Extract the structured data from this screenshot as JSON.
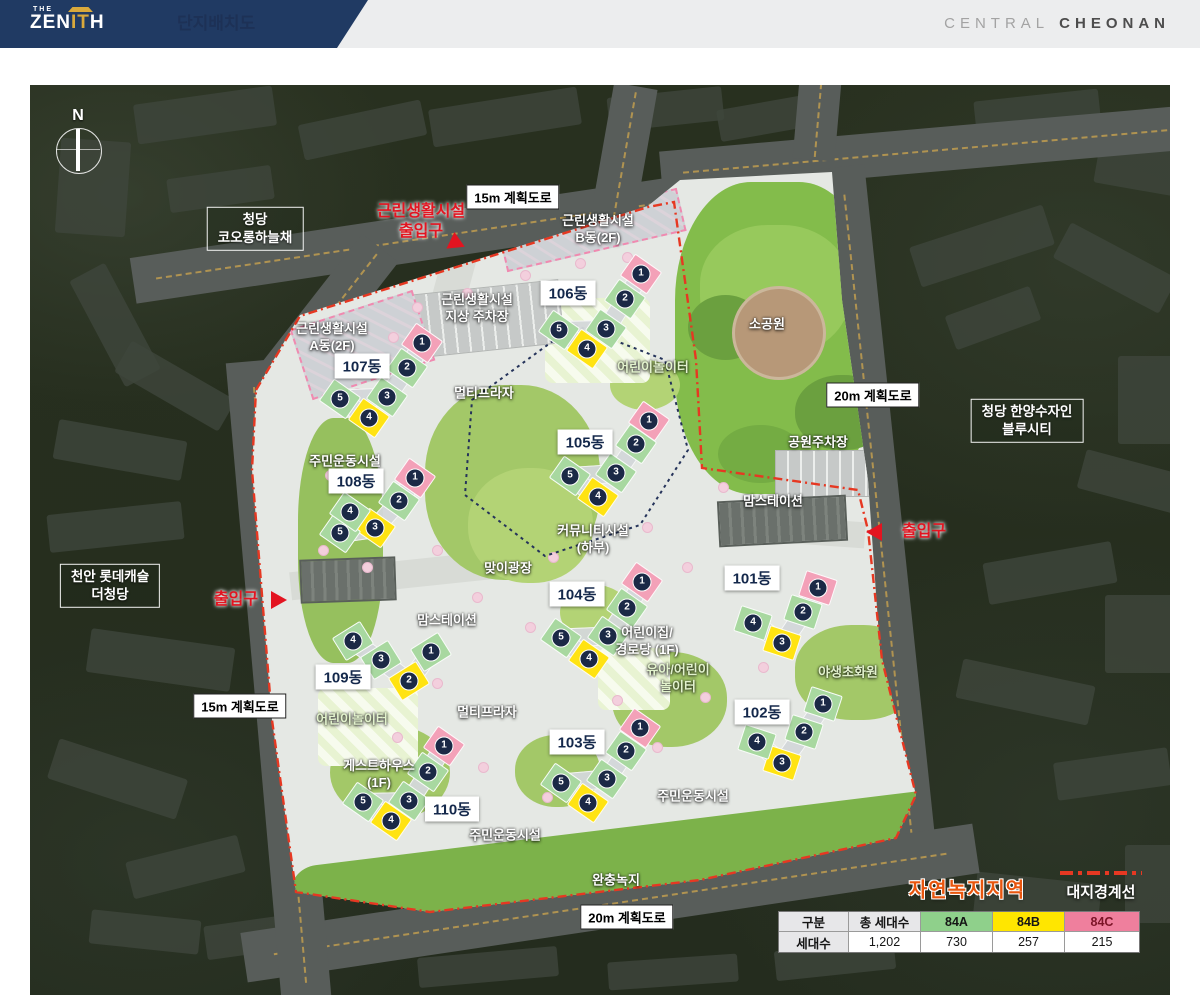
{
  "header": {
    "logo": {
      "the": "THE",
      "zen": "ZEN",
      "pillars": "IT",
      "th": "H"
    },
    "title": "단지배치도",
    "brand": {
      "light": "CENTRAL",
      "bold": "CHEONAN"
    }
  },
  "map": {
    "compass": "N",
    "road_labels": [
      {
        "text": "15m 계획도로",
        "x": 513,
        "y": 197
      },
      {
        "text": "15m 계획도로",
        "x": 240,
        "y": 706
      },
      {
        "text": "20m 계획도로",
        "x": 873,
        "y": 395
      },
      {
        "text": "20m 계획도로",
        "x": 627,
        "y": 917
      }
    ],
    "neighbors": [
      {
        "lines": [
          "청당",
          "코오롱하늘채"
        ],
        "x": 255,
        "y": 229
      },
      {
        "lines": [
          "청당 한양수자인",
          "블루시티"
        ],
        "x": 1027,
        "y": 421
      },
      {
        "lines": [
          "천안 롯데캐슬",
          "더청당"
        ],
        "x": 110,
        "y": 586
      }
    ],
    "entrances": [
      {
        "lines": [
          "근린생활시설",
          "출입구"
        ],
        "x": 421,
        "y": 222,
        "tri": {
          "x": 453,
          "y": 244,
          "dir": "left",
          "rot": -35
        }
      },
      {
        "lines": [
          "출입구"
        ],
        "x": 236,
        "y": 600,
        "tri": {
          "x": 279,
          "y": 600,
          "dir": "right",
          "rot": 0
        }
      },
      {
        "lines": [
          "출입구"
        ],
        "x": 924,
        "y": 532,
        "tri": {
          "x": 874,
          "y": 532,
          "dir": "left",
          "rot": 0
        }
      }
    ],
    "facilities": [
      {
        "lines": [
          "근린생활시설",
          "지상 주차장"
        ],
        "x": 477,
        "y": 309,
        "tone": "w"
      },
      {
        "lines": [
          "근린생활시설",
          "B동(2F)"
        ],
        "x": 598,
        "y": 230,
        "tone": "w"
      },
      {
        "lines": [
          "근린생활시설",
          "A동(2F)"
        ],
        "x": 332,
        "y": 338,
        "tone": "w"
      },
      {
        "lines": [
          "멀티프라자"
        ],
        "x": 484,
        "y": 394,
        "tone": "w"
      },
      {
        "lines": [
          "멀티프라자"
        ],
        "x": 487,
        "y": 713,
        "tone": "w"
      },
      {
        "lines": [
          "주민운동시설"
        ],
        "x": 345,
        "y": 462,
        "tone": "w"
      },
      {
        "lines": [
          "주민운동시설"
        ],
        "x": 505,
        "y": 836,
        "tone": "w"
      },
      {
        "lines": [
          "주민운동시설"
        ],
        "x": 693,
        "y": 797,
        "tone": "w"
      },
      {
        "lines": [
          "어린이놀이터"
        ],
        "x": 653,
        "y": 368,
        "tone": "g"
      },
      {
        "lines": [
          "어린이놀이터"
        ],
        "x": 352,
        "y": 720,
        "tone": "g"
      },
      {
        "lines": [
          "유아/어린이",
          "놀이터"
        ],
        "x": 678,
        "y": 679,
        "tone": "g"
      },
      {
        "lines": [
          "야생초화원"
        ],
        "x": 848,
        "y": 673,
        "tone": "g"
      },
      {
        "lines": [
          "커뮤니티시설",
          "(하부)"
        ],
        "x": 593,
        "y": 540,
        "tone": "w"
      },
      {
        "lines": [
          "맞이광장"
        ],
        "x": 508,
        "y": 569,
        "tone": "w"
      },
      {
        "lines": [
          "맘스테이션"
        ],
        "x": 773,
        "y": 502,
        "tone": "w"
      },
      {
        "lines": [
          "맘스테이션"
        ],
        "x": 447,
        "y": 621,
        "tone": "w"
      },
      {
        "lines": [
          "어린이집/",
          "경로당 (1F)"
        ],
        "x": 647,
        "y": 642,
        "tone": "w"
      },
      {
        "lines": [
          "게스트하우스",
          "(1F)"
        ],
        "x": 379,
        "y": 775,
        "tone": "w"
      },
      {
        "lines": [
          "소공원"
        ],
        "x": 767,
        "y": 325,
        "tone": "w"
      },
      {
        "lines": [
          "공원주차장"
        ],
        "x": 818,
        "y": 443,
        "tone": "w"
      },
      {
        "lines": [
          "완충녹지"
        ],
        "x": 616,
        "y": 881,
        "tone": "w"
      }
    ],
    "dong_labels": [
      {
        "text": "101동",
        "x": 752,
        "y": 578
      },
      {
        "text": "102동",
        "x": 762,
        "y": 712
      },
      {
        "text": "103동",
        "x": 577,
        "y": 742
      },
      {
        "text": "104동",
        "x": 577,
        "y": 594
      },
      {
        "text": "105동",
        "x": 585,
        "y": 442
      },
      {
        "text": "106동",
        "x": 568,
        "y": 293
      },
      {
        "text": "107동",
        "x": 362,
        "y": 366
      },
      {
        "text": "108동",
        "x": 356,
        "y": 481
      },
      {
        "text": "109동",
        "x": 343,
        "y": 677
      },
      {
        "text": "110동",
        "x": 452,
        "y": 809
      }
    ],
    "buildings": [
      {
        "name": "101동",
        "angle": 18,
        "units": [
          {
            "n": "1",
            "x": 818,
            "y": 588,
            "c": "pink"
          },
          {
            "n": "2",
            "x": 803,
            "y": 612,
            "c": "green"
          },
          {
            "n": "3",
            "x": 782,
            "y": 643,
            "c": "yellow"
          },
          {
            "n": "4",
            "x": 753,
            "y": 623,
            "c": "green"
          }
        ]
      },
      {
        "name": "102동",
        "angle": 18,
        "units": [
          {
            "n": "1",
            "x": 823,
            "y": 704,
            "c": "green"
          },
          {
            "n": "2",
            "x": 804,
            "y": 732,
            "c": "green"
          },
          {
            "n": "3",
            "x": 782,
            "y": 763,
            "c": "yellow"
          },
          {
            "n": "4",
            "x": 757,
            "y": 742,
            "c": "green"
          }
        ]
      },
      {
        "name": "103동",
        "angle": 35,
        "units": [
          {
            "n": "1",
            "x": 640,
            "y": 728,
            "c": "pink"
          },
          {
            "n": "2",
            "x": 626,
            "y": 751,
            "c": "green"
          },
          {
            "n": "3",
            "x": 607,
            "y": 779,
            "c": "green"
          },
          {
            "n": "5",
            "x": 561,
            "y": 783,
            "c": "green"
          },
          {
            "n": "4",
            "x": 588,
            "y": 803,
            "c": "yellow"
          }
        ]
      },
      {
        "name": "104동",
        "angle": 35,
        "units": [
          {
            "n": "1",
            "x": 642,
            "y": 582,
            "c": "pink"
          },
          {
            "n": "2",
            "x": 627,
            "y": 608,
            "c": "green"
          },
          {
            "n": "3",
            "x": 608,
            "y": 636,
            "c": "green"
          },
          {
            "n": "5",
            "x": 561,
            "y": 638,
            "c": "green"
          },
          {
            "n": "4",
            "x": 589,
            "y": 659,
            "c": "yellow"
          }
        ]
      },
      {
        "name": "105동",
        "angle": 35,
        "units": [
          {
            "n": "1",
            "x": 649,
            "y": 421,
            "c": "pink"
          },
          {
            "n": "2",
            "x": 636,
            "y": 444,
            "c": "green"
          },
          {
            "n": "3",
            "x": 616,
            "y": 473,
            "c": "green"
          },
          {
            "n": "5",
            "x": 570,
            "y": 476,
            "c": "green"
          },
          {
            "n": "4",
            "x": 598,
            "y": 497,
            "c": "yellow"
          }
        ]
      },
      {
        "name": "106동",
        "angle": 35,
        "units": [
          {
            "n": "1",
            "x": 641,
            "y": 274,
            "c": "pink"
          },
          {
            "n": "2",
            "x": 625,
            "y": 299,
            "c": "green"
          },
          {
            "n": "3",
            "x": 606,
            "y": 329,
            "c": "green"
          },
          {
            "n": "5",
            "x": 559,
            "y": 330,
            "c": "green"
          },
          {
            "n": "4",
            "x": 587,
            "y": 349,
            "c": "yellow"
          }
        ]
      },
      {
        "name": "107동",
        "angle": 35,
        "units": [
          {
            "n": "1",
            "x": 422,
            "y": 343,
            "c": "pink"
          },
          {
            "n": "2",
            "x": 407,
            "y": 368,
            "c": "green"
          },
          {
            "n": "3",
            "x": 387,
            "y": 397,
            "c": "green"
          },
          {
            "n": "5",
            "x": 340,
            "y": 399,
            "c": "green"
          },
          {
            "n": "4",
            "x": 369,
            "y": 418,
            "c": "yellow"
          }
        ]
      },
      {
        "name": "108동",
        "angle": 35,
        "units": [
          {
            "n": "1",
            "x": 415,
            "y": 478,
            "c": "pink"
          },
          {
            "n": "2",
            "x": 399,
            "y": 501,
            "c": "green"
          },
          {
            "n": "3",
            "x": 375,
            "y": 528,
            "c": "yellow"
          },
          {
            "n": "5",
            "x": 340,
            "y": 533,
            "c": "green"
          },
          {
            "n": "4",
            "x": 350,
            "y": 512,
            "c": "green"
          }
        ]
      },
      {
        "name": "109동",
        "angle": -32,
        "units": [
          {
            "n": "4",
            "x": 353,
            "y": 641,
            "c": "green"
          },
          {
            "n": "3",
            "x": 381,
            "y": 660,
            "c": "green"
          },
          {
            "n": "2",
            "x": 409,
            "y": 681,
            "c": "yellow"
          },
          {
            "n": "1",
            "x": 431,
            "y": 652,
            "c": "green"
          }
        ]
      },
      {
        "name": "110동",
        "angle": 35,
        "units": [
          {
            "n": "1",
            "x": 444,
            "y": 746,
            "c": "pink"
          },
          {
            "n": "2",
            "x": 428,
            "y": 772,
            "c": "green"
          },
          {
            "n": "3",
            "x": 409,
            "y": 801,
            "c": "green"
          },
          {
            "n": "5",
            "x": 363,
            "y": 802,
            "c": "green"
          },
          {
            "n": "4",
            "x": 391,
            "y": 821,
            "c": "yellow"
          }
        ]
      }
    ],
    "legend": {
      "zone": "자연녹지지역",
      "boundary": "대지경계선"
    },
    "table": {
      "col_headers": [
        {
          "label": "구분",
          "bg": "gray"
        },
        {
          "label": "총 세대수",
          "bg": "gray"
        },
        {
          "label": "84A",
          "bg": "green"
        },
        {
          "label": "84B",
          "bg": "yellow"
        },
        {
          "label": "84C",
          "bg": "pink"
        }
      ],
      "rows": [
        {
          "label": "세대수",
          "values": [
            "1,202",
            "730",
            "257",
            "215"
          ]
        }
      ]
    }
  },
  "colors": {
    "accent_red": "#e31420",
    "navy": "#1d3156",
    "unit_green": "#a8d8a0",
    "unit_yellow": "#ffe312",
    "unit_pink": "#f3a1b8",
    "table_green": "#8fd08b",
    "table_yellow": "#ffe600",
    "table_pink": "#ef7f9d"
  }
}
